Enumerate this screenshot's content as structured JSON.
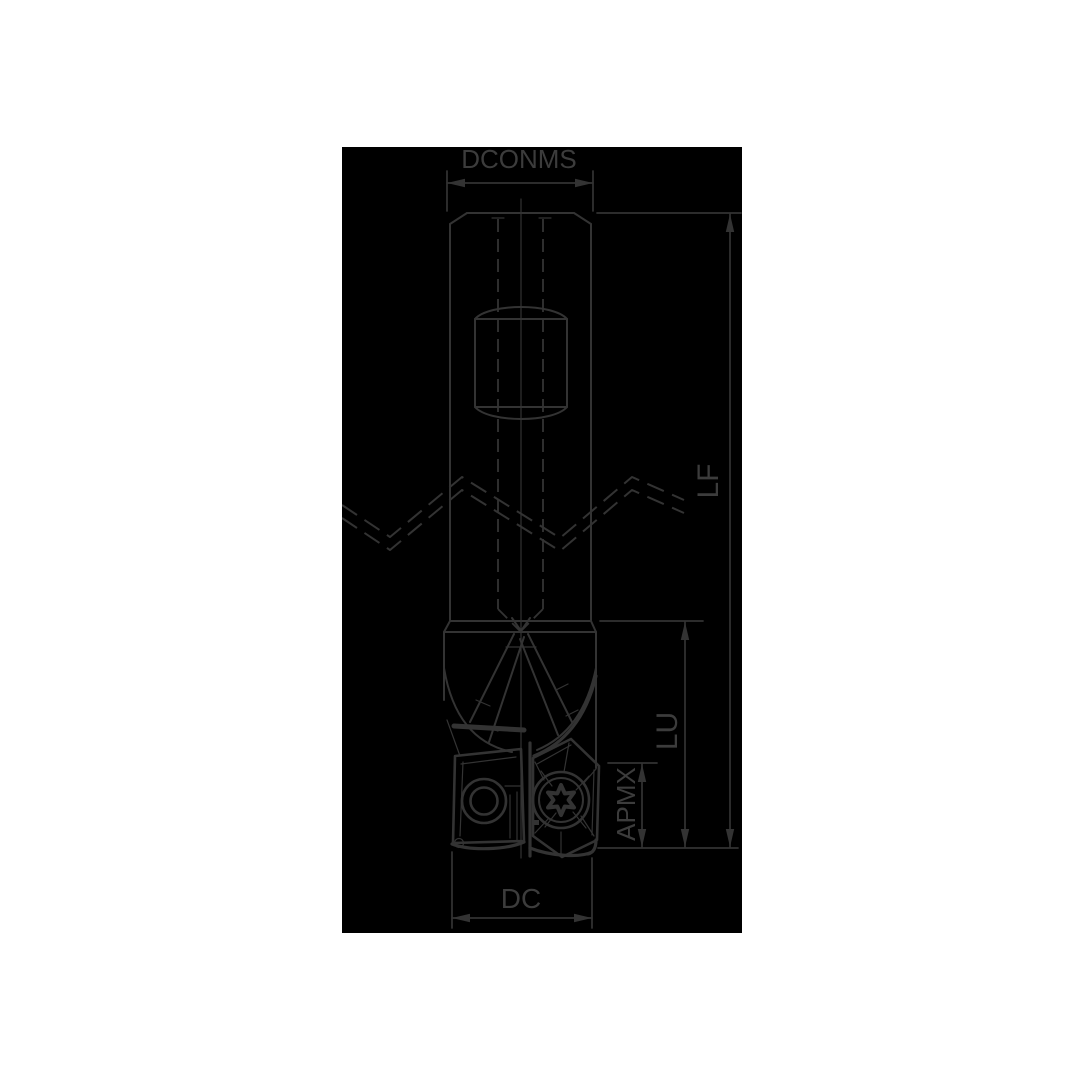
{
  "drawing": {
    "description": "technical dimension drawing of an indexable insert end mill",
    "dimensions": {
      "dconms": {
        "label": "DCONMS"
      },
      "lf": {
        "label": "LF"
      },
      "lu": {
        "label": "LU"
      },
      "apmx": {
        "label": "APMX"
      },
      "dc": {
        "label": "DC"
      }
    }
  },
  "colors": {
    "page-bg": "#ffffff",
    "canvas-bg": "#000000",
    "line": "#333333",
    "text": "#3c3c3c"
  }
}
